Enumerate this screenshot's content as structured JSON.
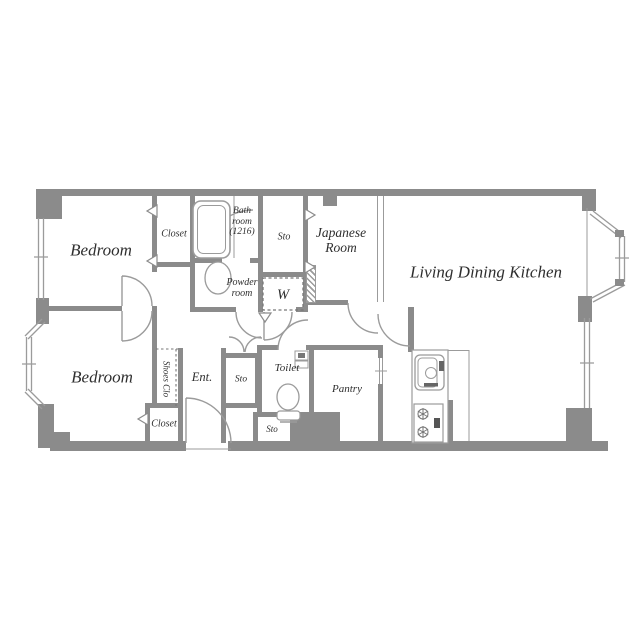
{
  "plan_title": "apartment-floor-plan",
  "rooms": {
    "bedroom_top": "Bedroom",
    "closet_top": "Closet",
    "bathroom": "Bath room (1216)",
    "sto_top": "Sto",
    "japanese_room": "Japanese Room",
    "ldk": "Living Dining Kitchen",
    "powder_room": "Powder room",
    "washer": "W",
    "bedroom_bottom": "Bedroom",
    "shoes_closet": "Shoes Clo",
    "entrance": "Ent.",
    "sto_hall": "Sto",
    "toilet": "Toilet",
    "sto_outer": "Sto",
    "pantry": "Pantry",
    "closet_bottom": "Closet"
  },
  "colors": {
    "wall": "#8b8b8b",
    "line": "#9b9b9b",
    "text": "#2f2f2f",
    "background": "#ffffff"
  }
}
